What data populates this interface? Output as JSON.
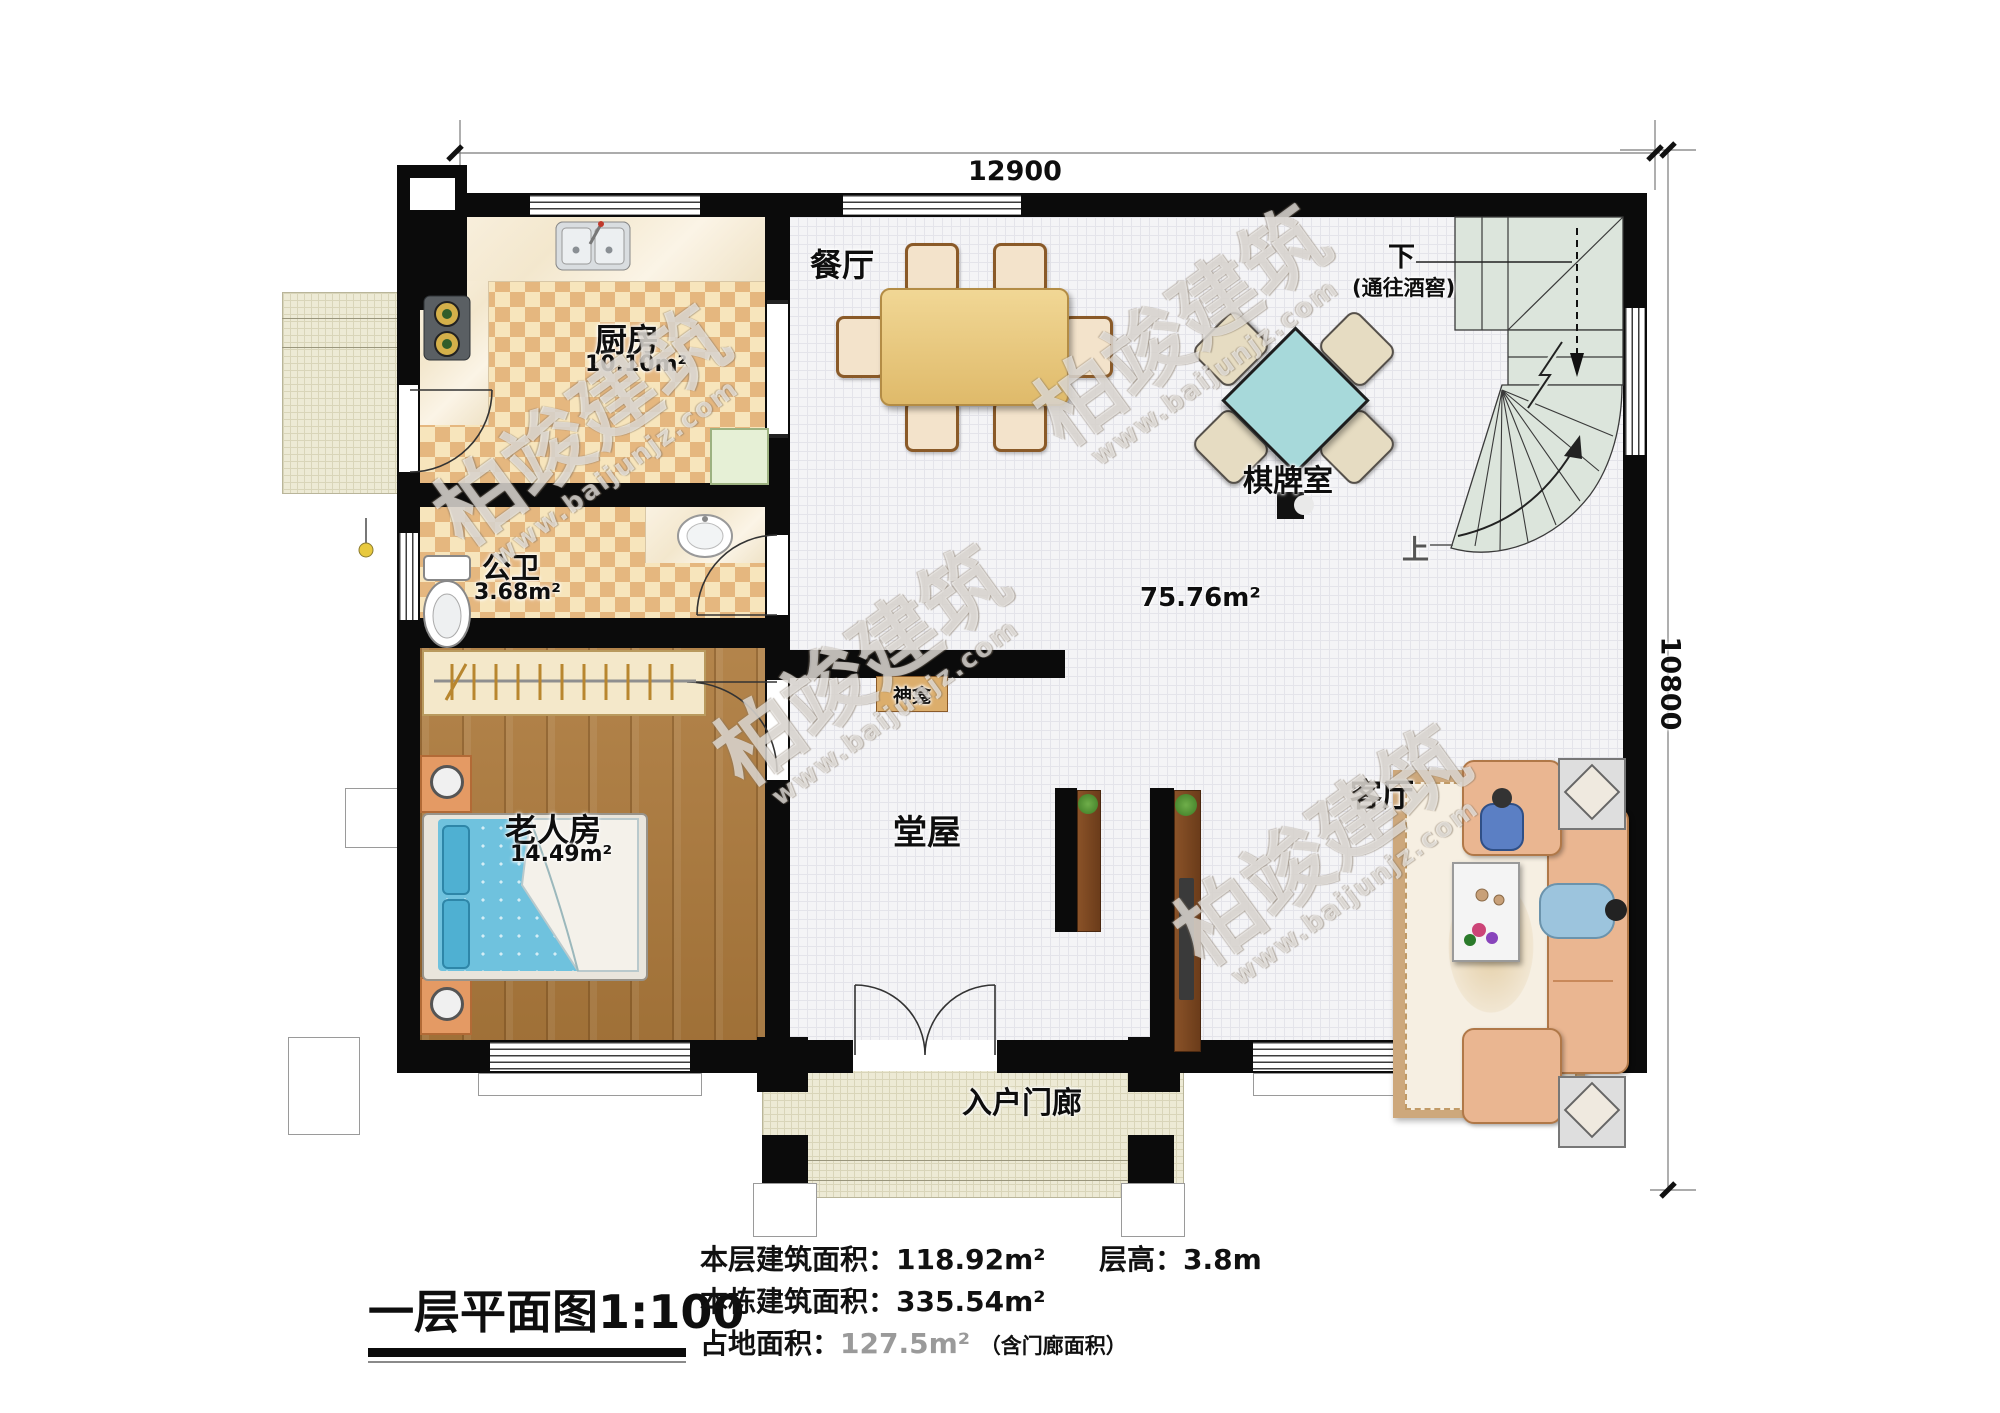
{
  "watermark": {
    "brand": "柏竣建筑",
    "site": "www.baijunjz.com"
  },
  "dims": {
    "top": "12900",
    "right": "10800"
  },
  "rooms": {
    "dining": {
      "name": "餐厅"
    },
    "kitchen": {
      "name": "厨房",
      "area": "10.10m²"
    },
    "bath": {
      "name": "公卫",
      "area": "3.68m²"
    },
    "elder": {
      "name": "老人房",
      "area": "14.49m²"
    },
    "chess": {
      "name": "棋牌室"
    },
    "open_area": {
      "area": "75.76m²"
    },
    "hall": {
      "name": "堂屋"
    },
    "living": {
      "name": "客厅"
    },
    "porch": {
      "name": "入户门廊"
    },
    "shrine": {
      "name": "神龛"
    }
  },
  "stairs": {
    "down": "下",
    "down_note": "(通往酒窖)",
    "up": "上"
  },
  "footer": {
    "title": "一层平面图",
    "scale": "1:100",
    "area_label": "本层建筑面积：",
    "area_value": "118.92m²",
    "height_label": "层高：",
    "height_value": "3.8m",
    "total_label": "本栋建筑面积：",
    "total_value": "335.54m²",
    "land_label": "占地面积：",
    "land_value": "127.5m²",
    "land_note": "（含门廊面积）"
  }
}
